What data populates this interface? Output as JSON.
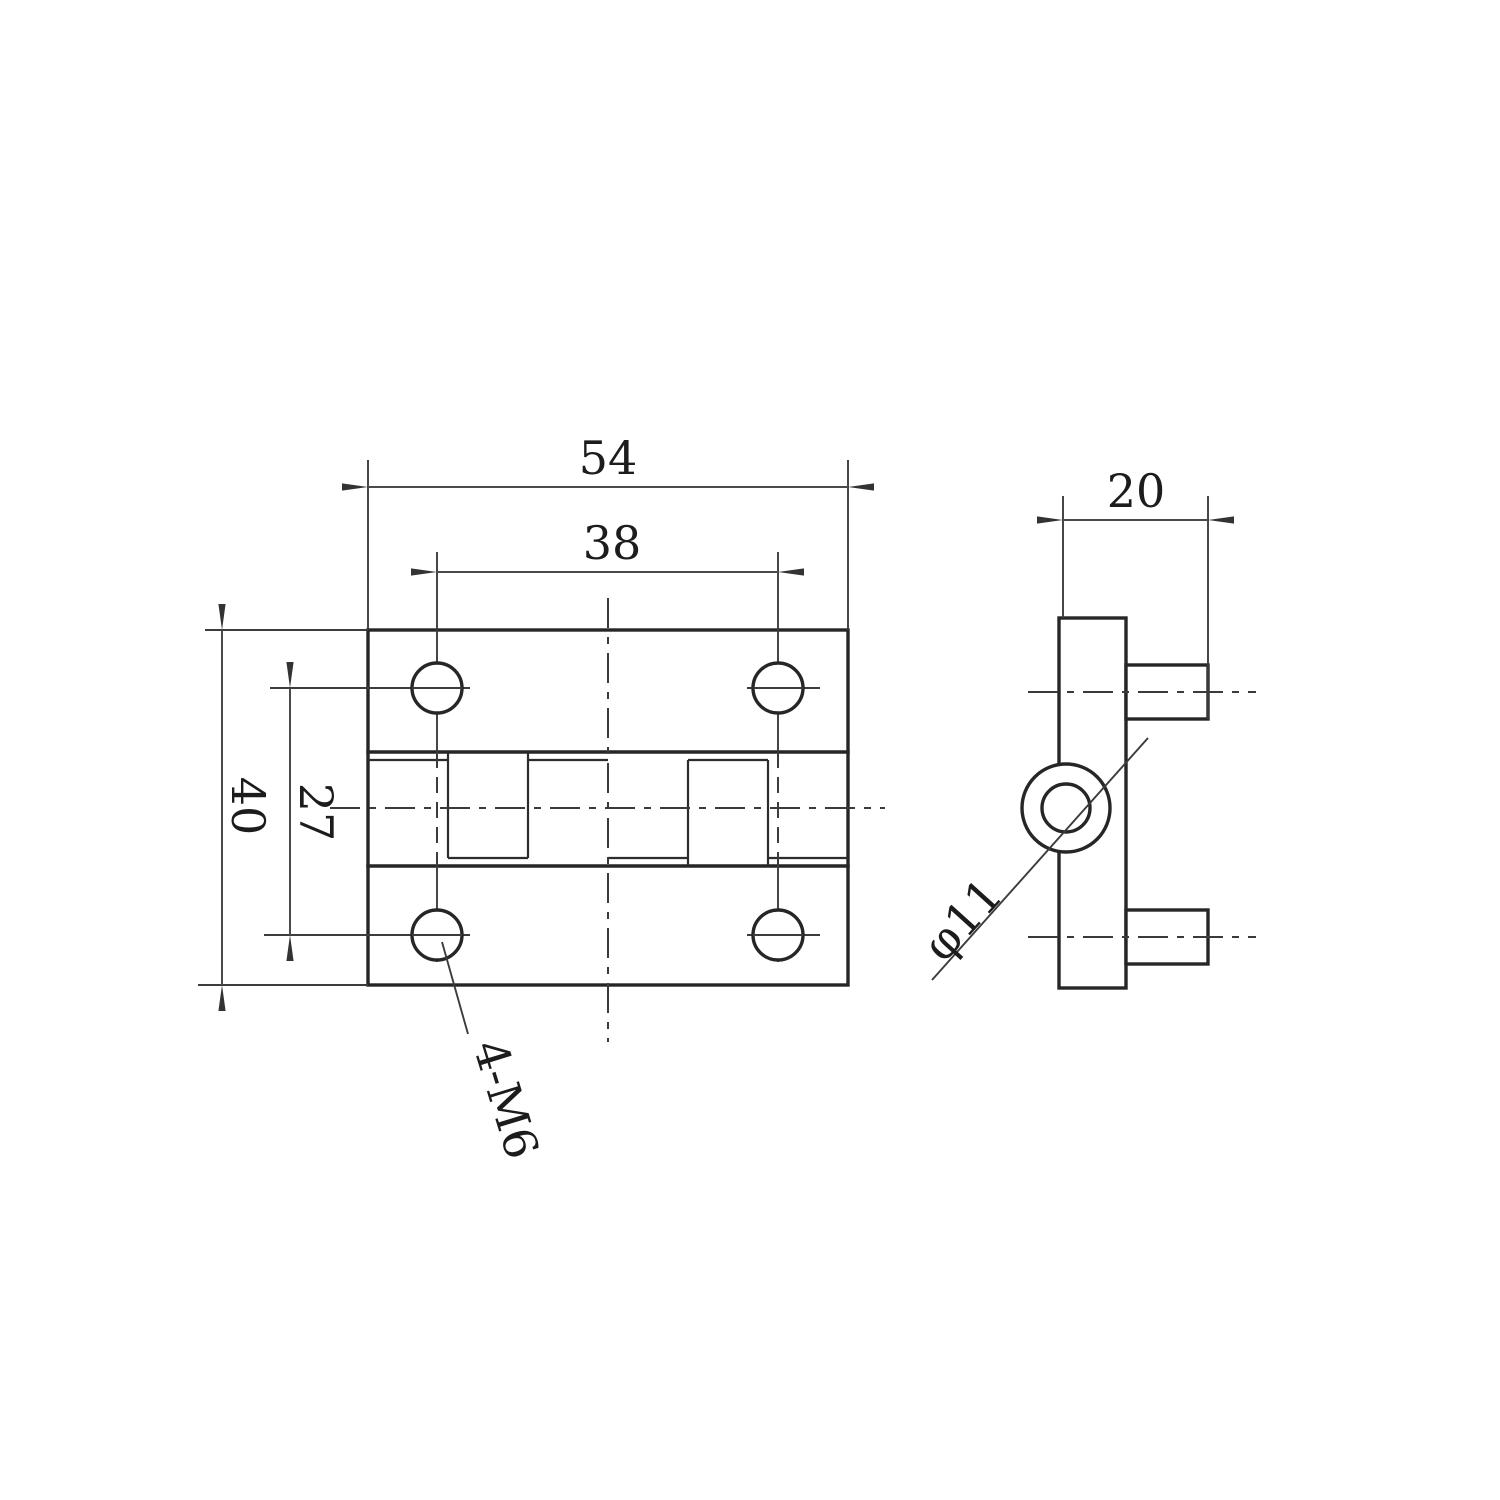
{
  "drawing": {
    "type": "technical-drawing",
    "subject": "hinge two-view dimensioned drawing",
    "colors": {
      "background": "#ffffff",
      "line": "#262626",
      "thin_line": "#3c3c3c",
      "text": "#1c1c1c"
    },
    "front_view": {
      "dims": {
        "overall_width": "54",
        "hole_spacing_horizontal": "38",
        "overall_height": "40",
        "hole_spacing_vertical": "27"
      },
      "callouts": {
        "holes": "4-M6"
      }
    },
    "side_view": {
      "dims": {
        "depth": "20"
      },
      "callouts": {
        "barrel_diameter": "φ11"
      }
    }
  }
}
